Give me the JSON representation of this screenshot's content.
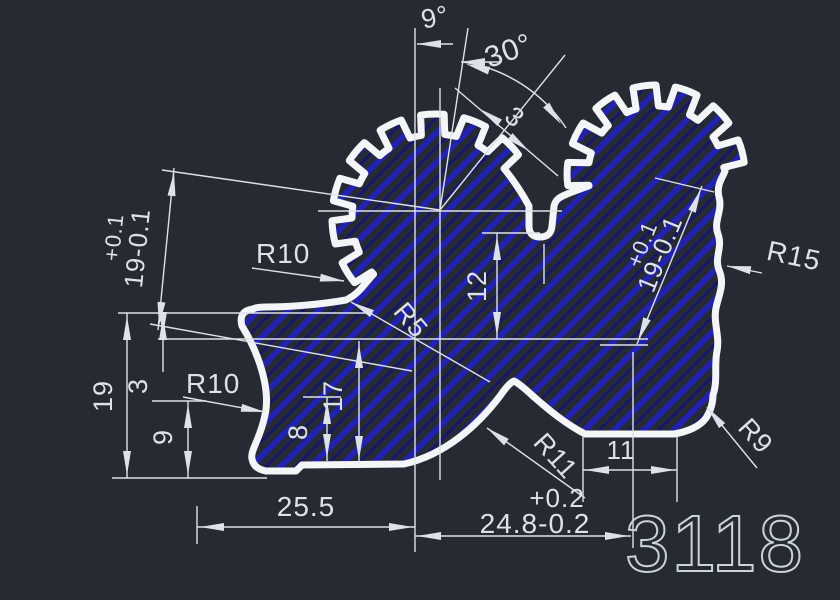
{
  "colors": {
    "background": "#252a33",
    "outline": "#f3f5f7",
    "hatch_blue": "#2121b2",
    "hatch_blue_dark": "#141478",
    "dimension": "#dde2e8",
    "number": "#ccd2d9"
  },
  "labels": {
    "angle_small": "9°",
    "angle_large": "30°",
    "tooth_width": "3",
    "left_tol_plus": "+0.1",
    "left_value": "19-0.1",
    "right_tol_plus": "+0.1",
    "right_value": "19-0.1",
    "radius_gear_left": "R10",
    "radius_block_left": "R10",
    "radius_root": "R5",
    "radius_right_side": "R15",
    "radius_corner": "R9",
    "radius_hump": "R11",
    "depth_12": "12",
    "height_19": "19",
    "height_3": "3",
    "height_9": "9",
    "height_17": "17",
    "height_8": "8",
    "width_25_5": "25.5",
    "width_tol_plus": "+0.2",
    "width_24_8": "24.8-0.2",
    "width_11": "11",
    "drawing_number": "3118"
  }
}
